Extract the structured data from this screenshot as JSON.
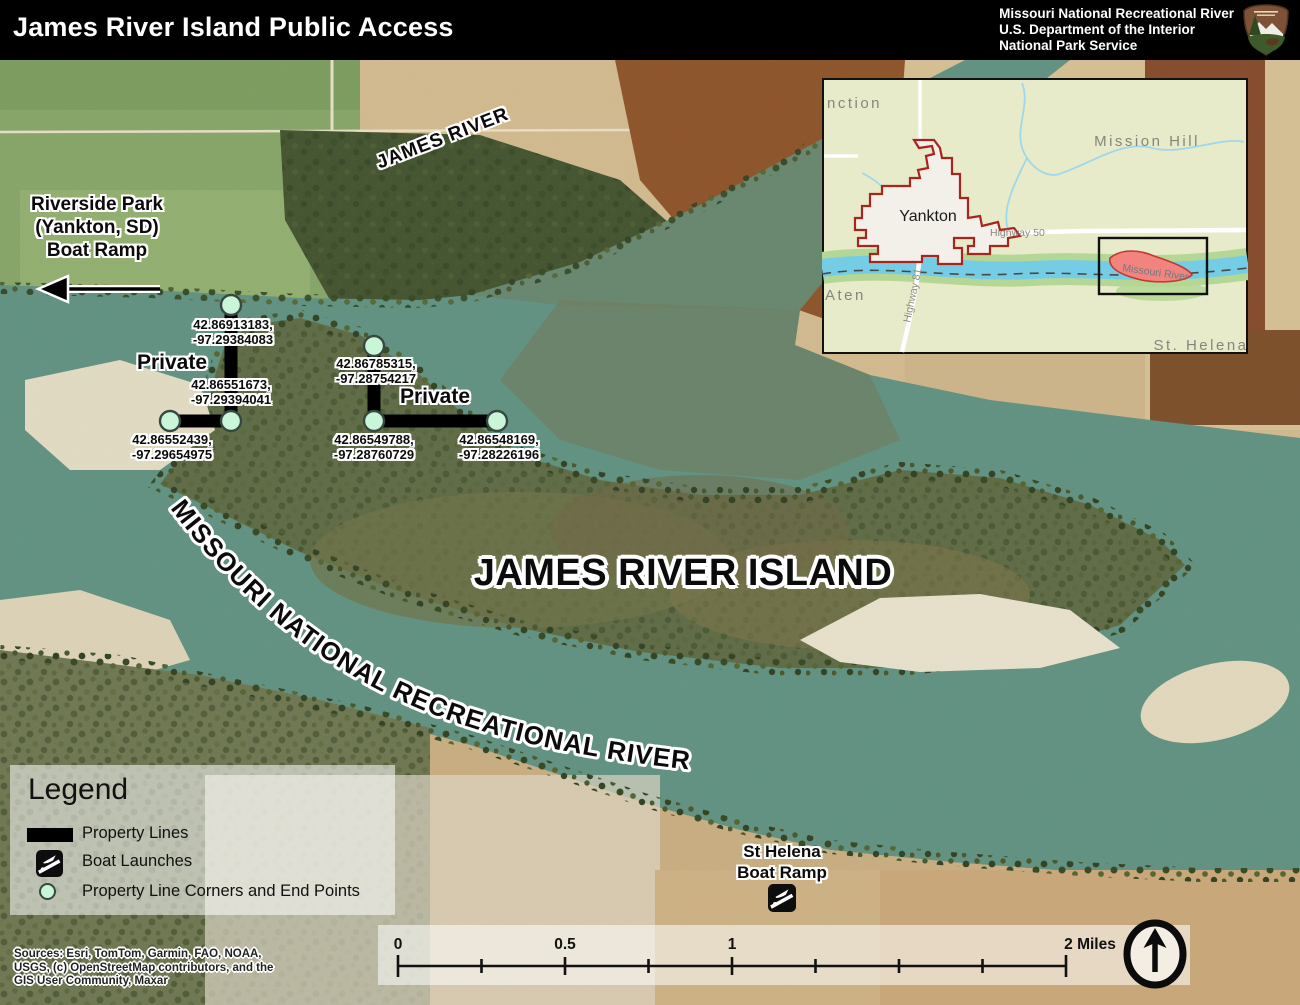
{
  "header": {
    "title": "James River Island Public Access",
    "agency_line1": "Missouri National Recreational River",
    "agency_line2": "U.S. Department of the Interior",
    "agency_line3": "National Park Service"
  },
  "map_labels": {
    "james_river": "JAMES RIVER",
    "island": "JAMES RIVER ISLAND",
    "recreational_river": "MISSOURI NATIONAL RECREATIONAL RIVER",
    "riverside_line1": "Riverside Park",
    "riverside_line2": "(Yankton, SD)",
    "riverside_line3": "Boat Ramp",
    "private_west": "Private",
    "private_east": "Private",
    "st_helena_line1": "St Helena",
    "st_helena_line2": "Boat Ramp"
  },
  "property_points": [
    {
      "line1": "42.86913183,",
      "line2": "-97.29384083"
    },
    {
      "line1": "42.86551673,",
      "line2": "-97.29394041"
    },
    {
      "line1": "42.86552439,",
      "line2": "-97.29654975"
    },
    {
      "line1": "42.86785315,",
      "line2": "-97.28754217"
    },
    {
      "line1": "42.86549788,",
      "line2": "-97.28760729"
    },
    {
      "line1": "42.86548169,",
      "line2": "-97.28226196"
    }
  ],
  "inset": {
    "junction_partial": "nction",
    "mission_hill": "Mission Hill",
    "yankton": "Yankton",
    "highway_50": "Highway 50",
    "highway_81": "Highway 81",
    "aten": "Aten",
    "missouri_river": "Missouri River",
    "st_helena": "St. Helena"
  },
  "legend": {
    "title": "Legend",
    "items": [
      {
        "label": "Property Lines"
      },
      {
        "label": "Boat Launches"
      },
      {
        "label": "Property Line Corners and End Points"
      }
    ]
  },
  "scalebar": {
    "labels": [
      "0",
      "0.5",
      "1",
      "2 Miles"
    ]
  },
  "sources": {
    "line1": "Sources:  Esri, TomTom, Garmin, FAO, NOAA,",
    "line2": "USGS, (c) OpenStreetMap contributors, and the",
    "line3": "GIS User Community, Maxar"
  },
  "colors": {
    "header_bg": "#000000",
    "marker_fill": "#c9f6d8",
    "marker_stroke": "#374840",
    "property_line": "#000000",
    "main_river": "#5f9181",
    "inset_river": "#74cde5",
    "inset_land": "#e8ebc9",
    "yankton_outline": "#a9231f",
    "island_highlight_fill": "#f2837e"
  }
}
